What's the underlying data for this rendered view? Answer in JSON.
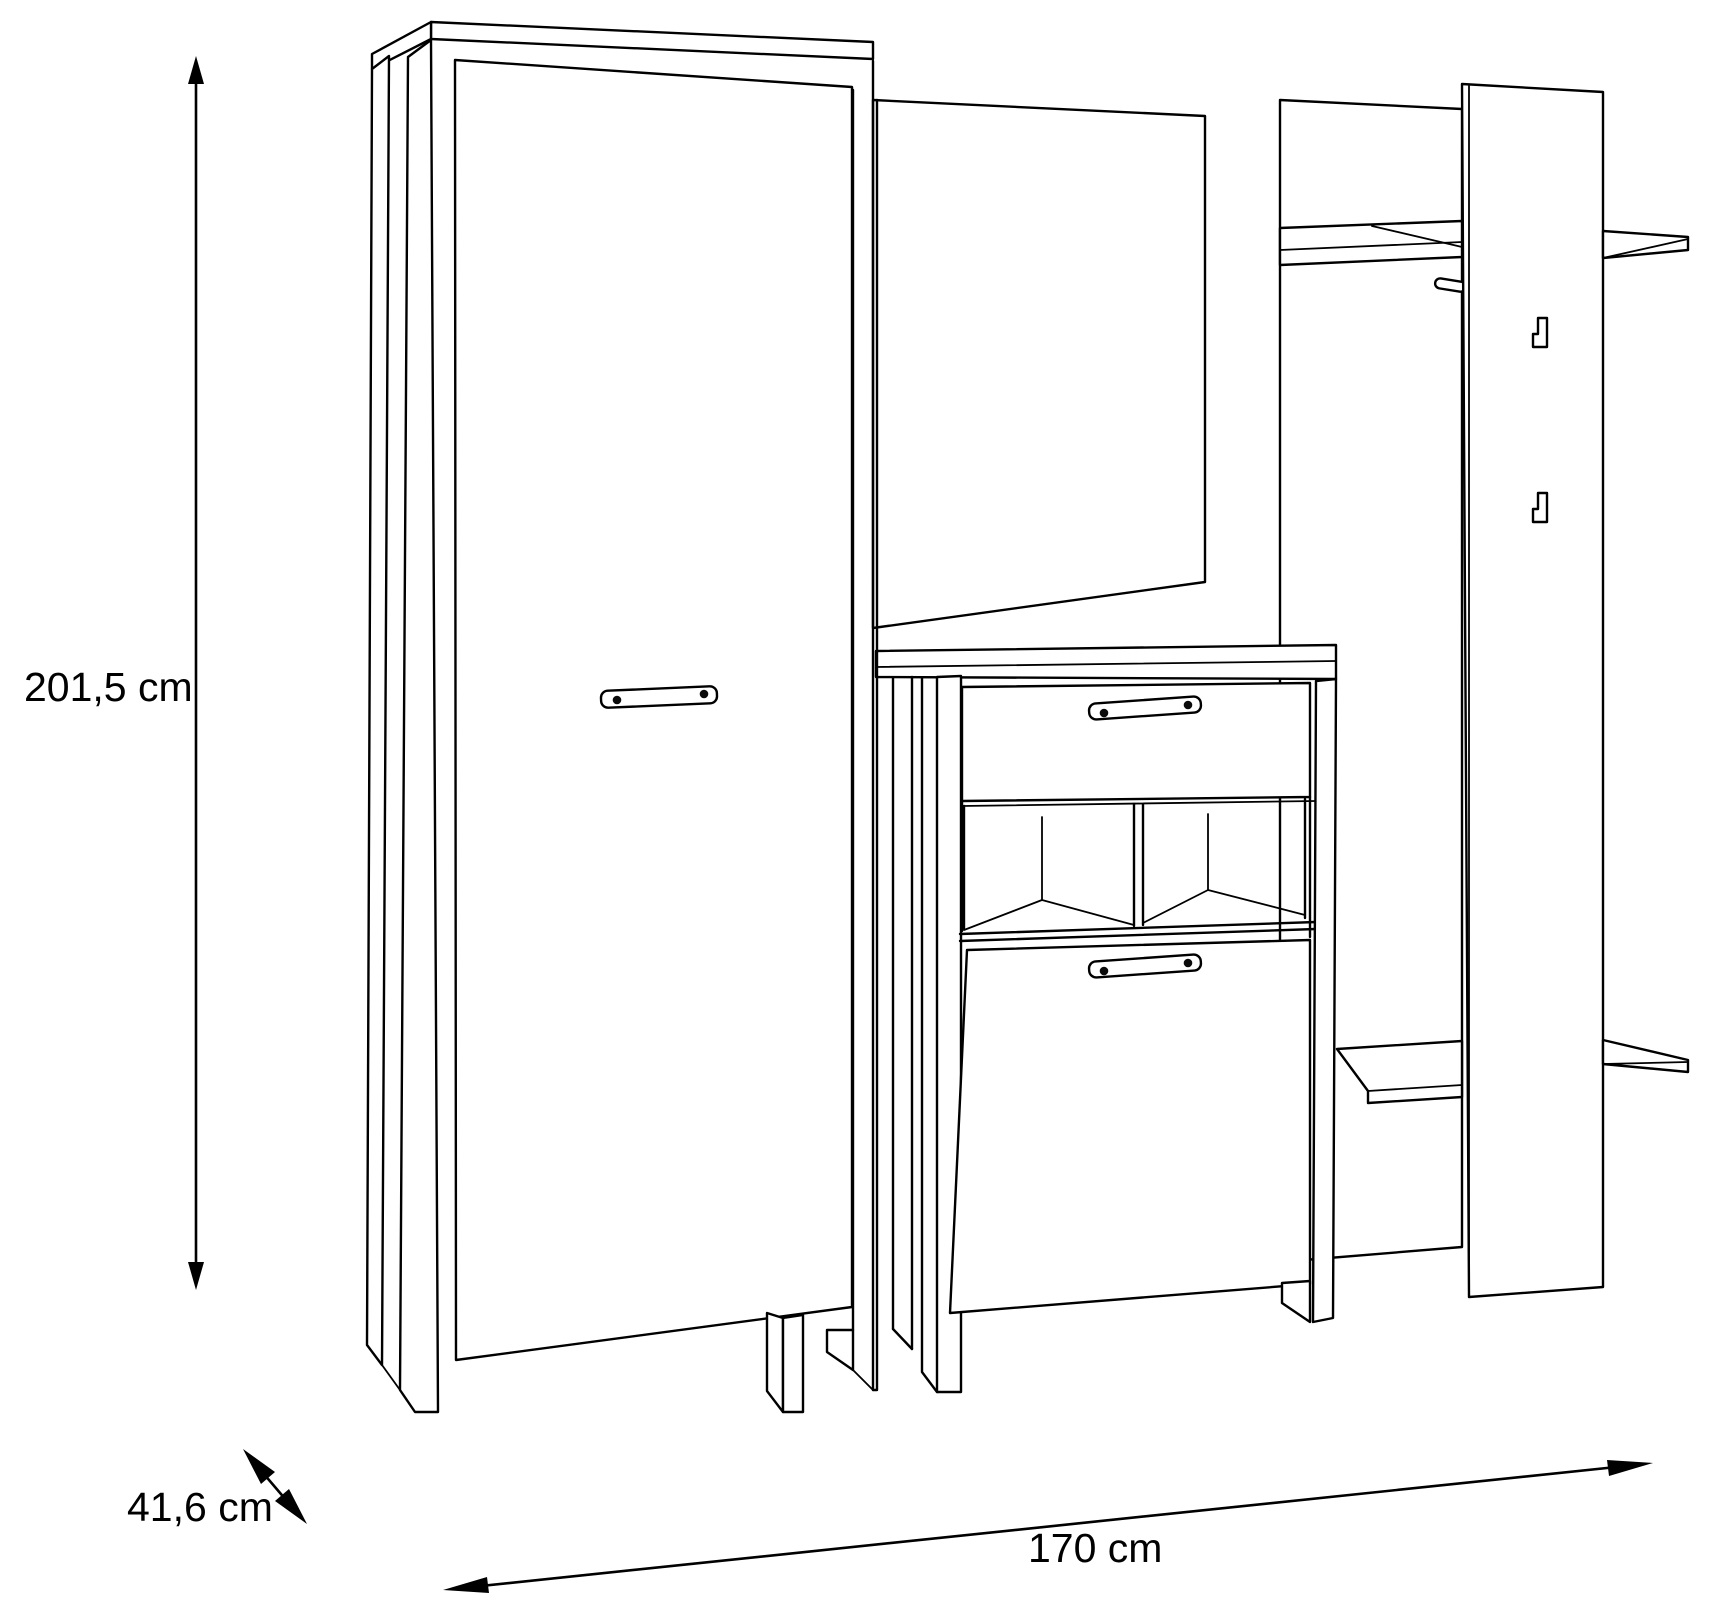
{
  "figure": {
    "kind": "furniture-dimension-diagram",
    "background_color": "#ffffff",
    "line_color": "#000000"
  },
  "dimensions": {
    "height_label": "201,5 cm",
    "depth_label": "41,6 cm",
    "width_label": "170 cm"
  }
}
